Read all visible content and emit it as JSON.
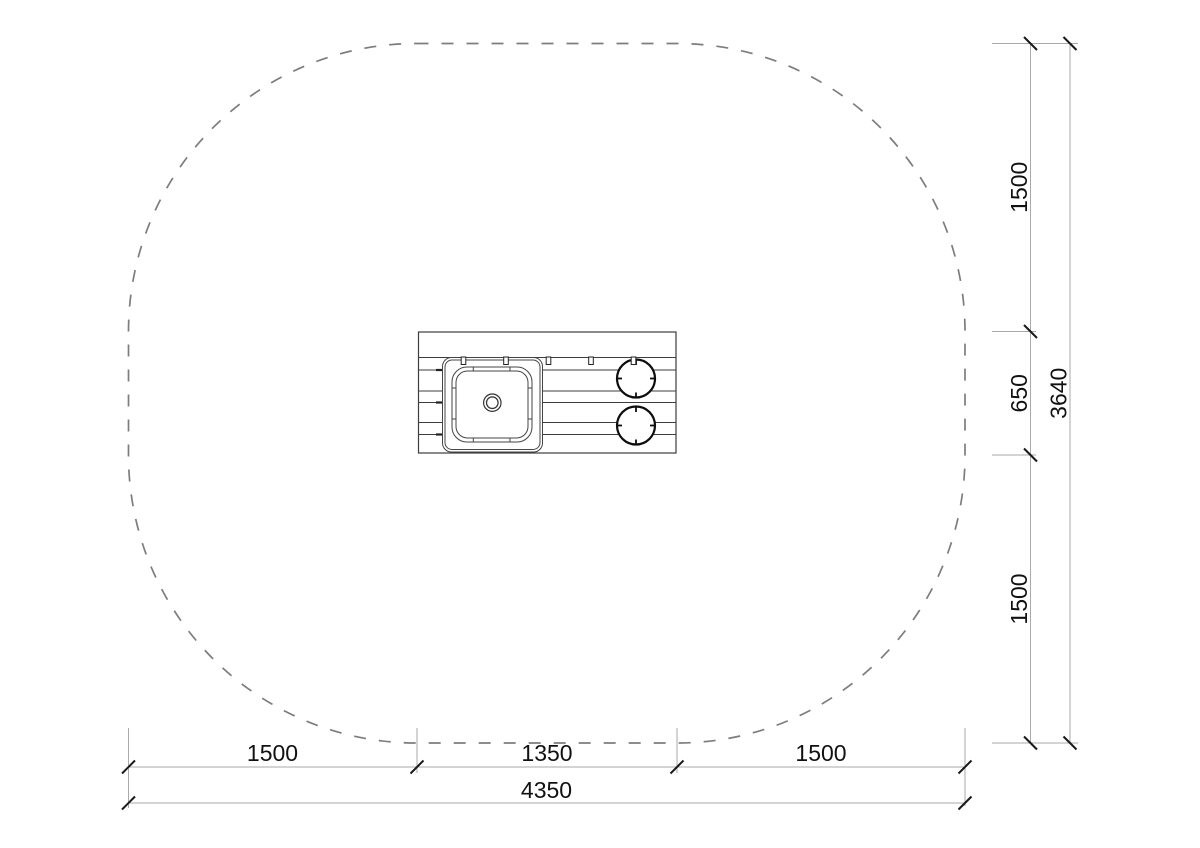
{
  "colors": {
    "background": "#ffffff",
    "zone_dash": "#7d7d7d",
    "drawing_line": "#3d3d3d",
    "bold_line": "#0d0d0d",
    "dimension_line": "#aaaaaa",
    "tick": "#1a1a1a",
    "text": "#111111"
  },
  "dimensions": {
    "bottom": {
      "segments": [
        {
          "label": "1500"
        },
        {
          "label": "1350"
        },
        {
          "label": "1500"
        }
      ],
      "total_label": "4350"
    },
    "right": {
      "segments": [
        {
          "label": "1500"
        },
        {
          "label": "650"
        },
        {
          "label": "1500"
        }
      ],
      "total_label": "3640"
    }
  }
}
